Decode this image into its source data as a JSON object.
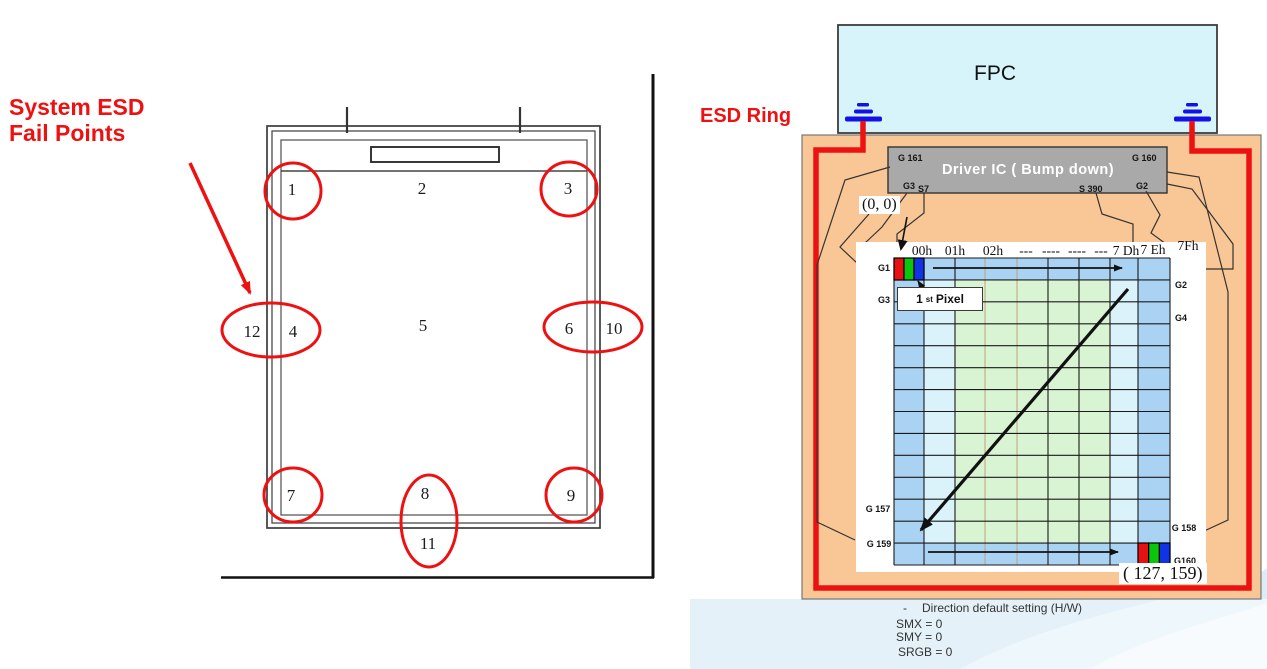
{
  "colors": {
    "red": "#ee1111",
    "ground_blue": "#1212e6",
    "fpc_fill": "#d6f4f9",
    "panel_fill": "#f8c795",
    "driver_fill": "#a9a9a9",
    "cell_border": "#a9d2f3",
    "cell_ring": "#daf3fb",
    "cell_center": "#d9f4d2"
  },
  "left": {
    "title_line1": "System ESD",
    "title_line2": "Fail Points",
    "points": {
      "p1": "1",
      "p2": "2",
      "p3": "3",
      "p4": "4",
      "p5": "5",
      "p6": "6",
      "p7": "7",
      "p8": "8",
      "p9": "9",
      "p10": "10",
      "p11": "11",
      "p12": "12"
    }
  },
  "right": {
    "esd_ring": "ESD Ring",
    "fpc": "FPC",
    "driver_ic": "Driver IC ( Bump down)",
    "pin_g161": "G 161",
    "pin_g160": "G 160",
    "pin_g3": "G3",
    "pin_s7": "S7",
    "pin_s390": "S 390",
    "pin_g2": "G2",
    "origin": "(0, 0)",
    "first_pixel_num": "1",
    "first_pixel_sup": "st",
    "first_pixel_word": "Pixel",
    "col_headers": [
      "00h",
      "01h",
      "02h",
      "---",
      "----",
      "----",
      "---",
      "7 Dh",
      "7 Eh",
      "7Fh"
    ],
    "row_g1": "G1",
    "row_g3": "G3",
    "row_g157": "G 157",
    "row_g159": "G 159",
    "row_g2": "G2",
    "row_g4": "G4",
    "row_g158": "G 158",
    "row_g160": "G160",
    "end_coord": "( 127, 159)",
    "note_dash": "-",
    "note_title": "Direction default setting  (H/W)",
    "note_smx": "SMX =  0",
    "note_smy": "SMY =  0",
    "note_srgb": "SRGB =  0"
  },
  "grid": {
    "x": [
      894,
      924,
      955,
      985,
      1017,
      1048,
      1079,
      1110,
      1138,
      1170
    ],
    "y_top": 258,
    "y_bottom": 565,
    "rows": 14,
    "tan_lines": [
      985,
      1017
    ],
    "line_color": "#1a1a1a",
    "tan_color": "#c2a276"
  }
}
